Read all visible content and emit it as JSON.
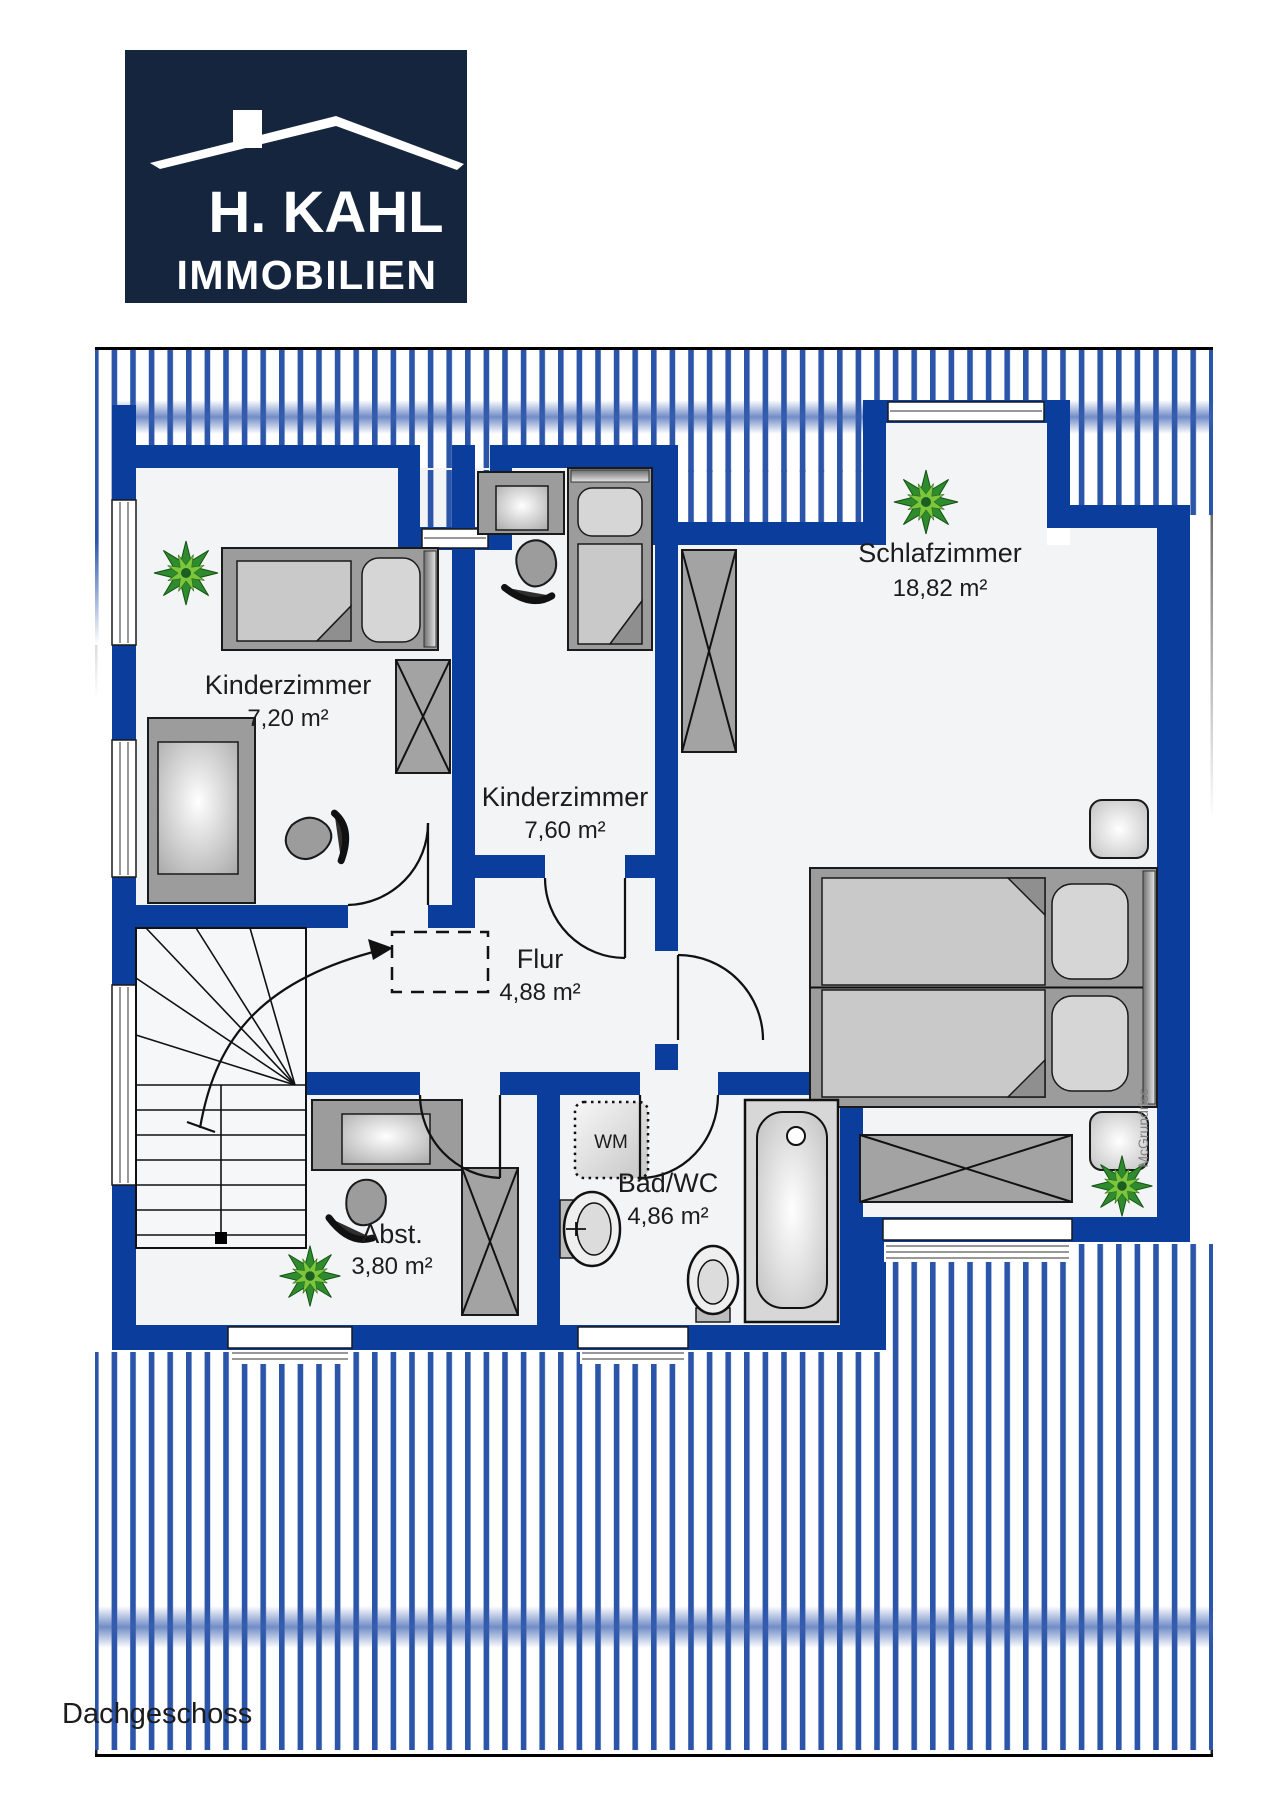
{
  "logo": {
    "title": "H. KAHL",
    "subtitle": "IMMOBILIEN"
  },
  "floor_label": "Dachgeschoss",
  "watermark": "McGrundriss",
  "appliances": {
    "washing_machine": "WM"
  },
  "rooms": [
    {
      "name": "Kinderzimmer",
      "area": "7,20 m²"
    },
    {
      "name": "Kinderzimmer",
      "area": "7,60 m²"
    },
    {
      "name": "Schlafzimmer",
      "area": "18,82 m²"
    },
    {
      "name": "Flur",
      "area": "4,88 m²"
    },
    {
      "name": "Abst.",
      "area": "3,80 m²"
    },
    {
      "name": "Bad/WC",
      "area": "4,86 m²"
    }
  ],
  "colors": {
    "wall_blue": "#0a3d9c",
    "hatch_blue": "#2b55a9",
    "band_blue": "#3a60b0",
    "logo_navy": "#16253e",
    "floor_fill": "#f3f4f6",
    "furniture_gray": "#9c9c9c",
    "text_dark": "#1c1c1c"
  }
}
